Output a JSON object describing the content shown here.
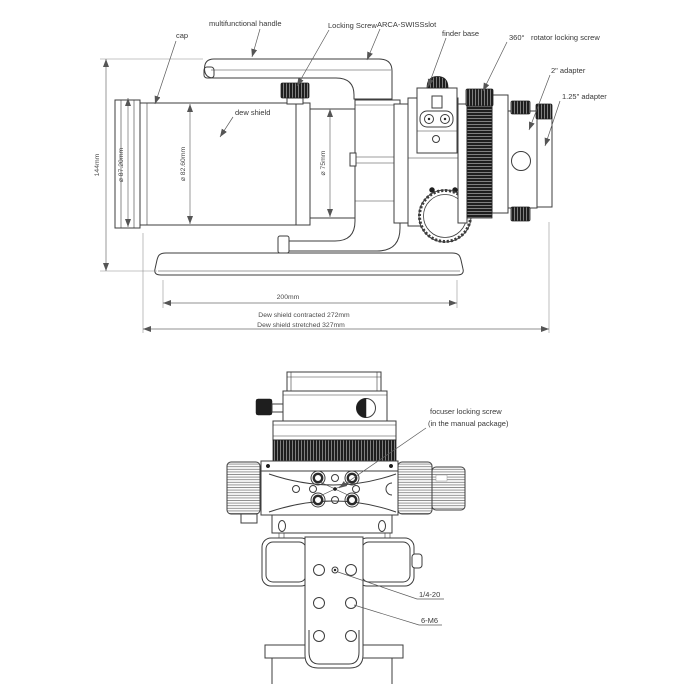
{
  "colors": {
    "line": "#3d3d3d",
    "dimension": "#6e6e6e",
    "dark_part": "#1e1e1e",
    "text": "#383838",
    "background": "#ffffff"
  },
  "side_view": {
    "labels": {
      "cap": "cap",
      "handle": "multifunctional handle",
      "locking_screw": "Locking Screw",
      "arca_slot": "ARCA-SWISSslot",
      "finder_base": "finder base",
      "rotator_deg": "360°",
      "rotator_screw": "rotator locking screw",
      "adapter_2in": "2\" adapter",
      "adapter_125in": "1.25\" adapter",
      "dew_shield": "dew shield"
    },
    "dims": {
      "height": "144mm",
      "cap_diameter": "⌀ 87.20mm",
      "shield_diameter": "⌀ 82.60mm",
      "tube_diameter": "⌀ 75mm",
      "plate_length": "200mm",
      "contracted": "Dew shield contracted 272mm",
      "stretched": "Dew shield stretched 327mm"
    }
  },
  "front_view": {
    "labels": {
      "focuser_screw_line1": "focuser locking screw",
      "focuser_screw_line2": "(in the manual package)",
      "thread_quarter": "1/4-20",
      "thread_m6": "6-M6"
    }
  }
}
